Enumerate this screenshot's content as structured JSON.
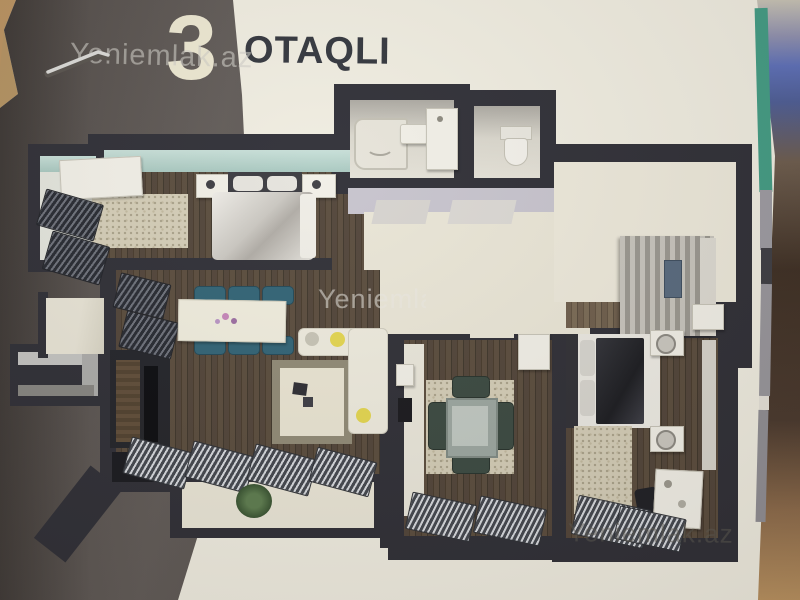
{
  "header": {
    "number": "3",
    "title": "OTAQLI"
  },
  "watermarks": {
    "top": "Yeniemlak.az",
    "center": "Yeniemlak.az",
    "bottom": "Yeniemlak.az"
  },
  "colors": {
    "page_cream": "#efece0",
    "side_band_gray": "#554f4c",
    "plan_walls_dark": "#2b2b33",
    "window_wall_teal": "#b7d4cc",
    "wood_floor": "#4a3e33",
    "tile_floor": "#e9e5d6",
    "hall_lavender": "#c6c3cd",
    "dining_chairs_teal": "#2d6073",
    "kitchen_chairs_green": "#37463e",
    "sofa_pillow_yellow": "#e3d54d",
    "page_edge_green": "#3f9a82",
    "title_number_cream": "#ebe6d0",
    "title_text_dark": "#2f323a"
  }
}
